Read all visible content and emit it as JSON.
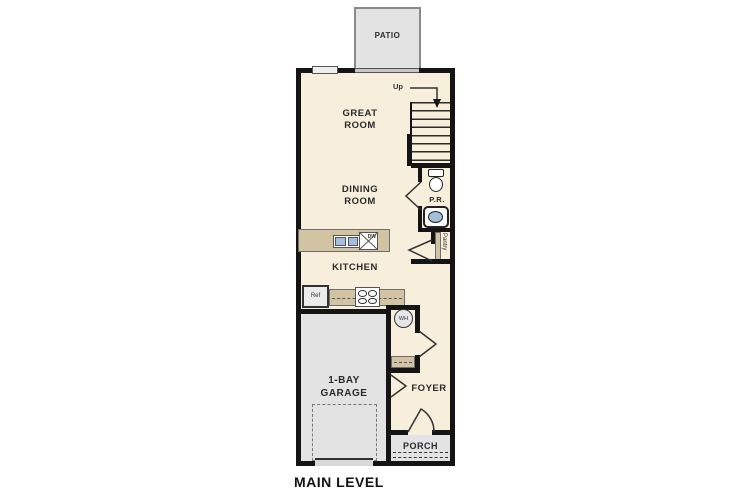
{
  "plan": {
    "title": "MAIN LEVEL",
    "rooms": {
      "patio": {
        "label": "PATIO"
      },
      "great_room": {
        "line1": "GREAT",
        "line2": "ROOM"
      },
      "dining_room": {
        "line1": "DINING",
        "line2": "ROOM"
      },
      "kitchen": {
        "label": "KITCHEN"
      },
      "powder_room": {
        "label": "P.R."
      },
      "pantry": {
        "label": "Pantry"
      },
      "garage": {
        "line1": "1-BAY",
        "line2": "GARAGE"
      },
      "foyer": {
        "label": "FOYER"
      },
      "porch": {
        "label": "PORCH"
      }
    },
    "fixtures": {
      "stairs_direction": "Up",
      "refrigerator": "Ref",
      "dishwasher": "DW",
      "water_heater": "WH"
    },
    "colors": {
      "floor": "#f7eedb",
      "outdoor": "#e3e3e3",
      "counter": "#d2c3a2",
      "wall": "#141414",
      "sink": "#a3bedd"
    }
  }
}
